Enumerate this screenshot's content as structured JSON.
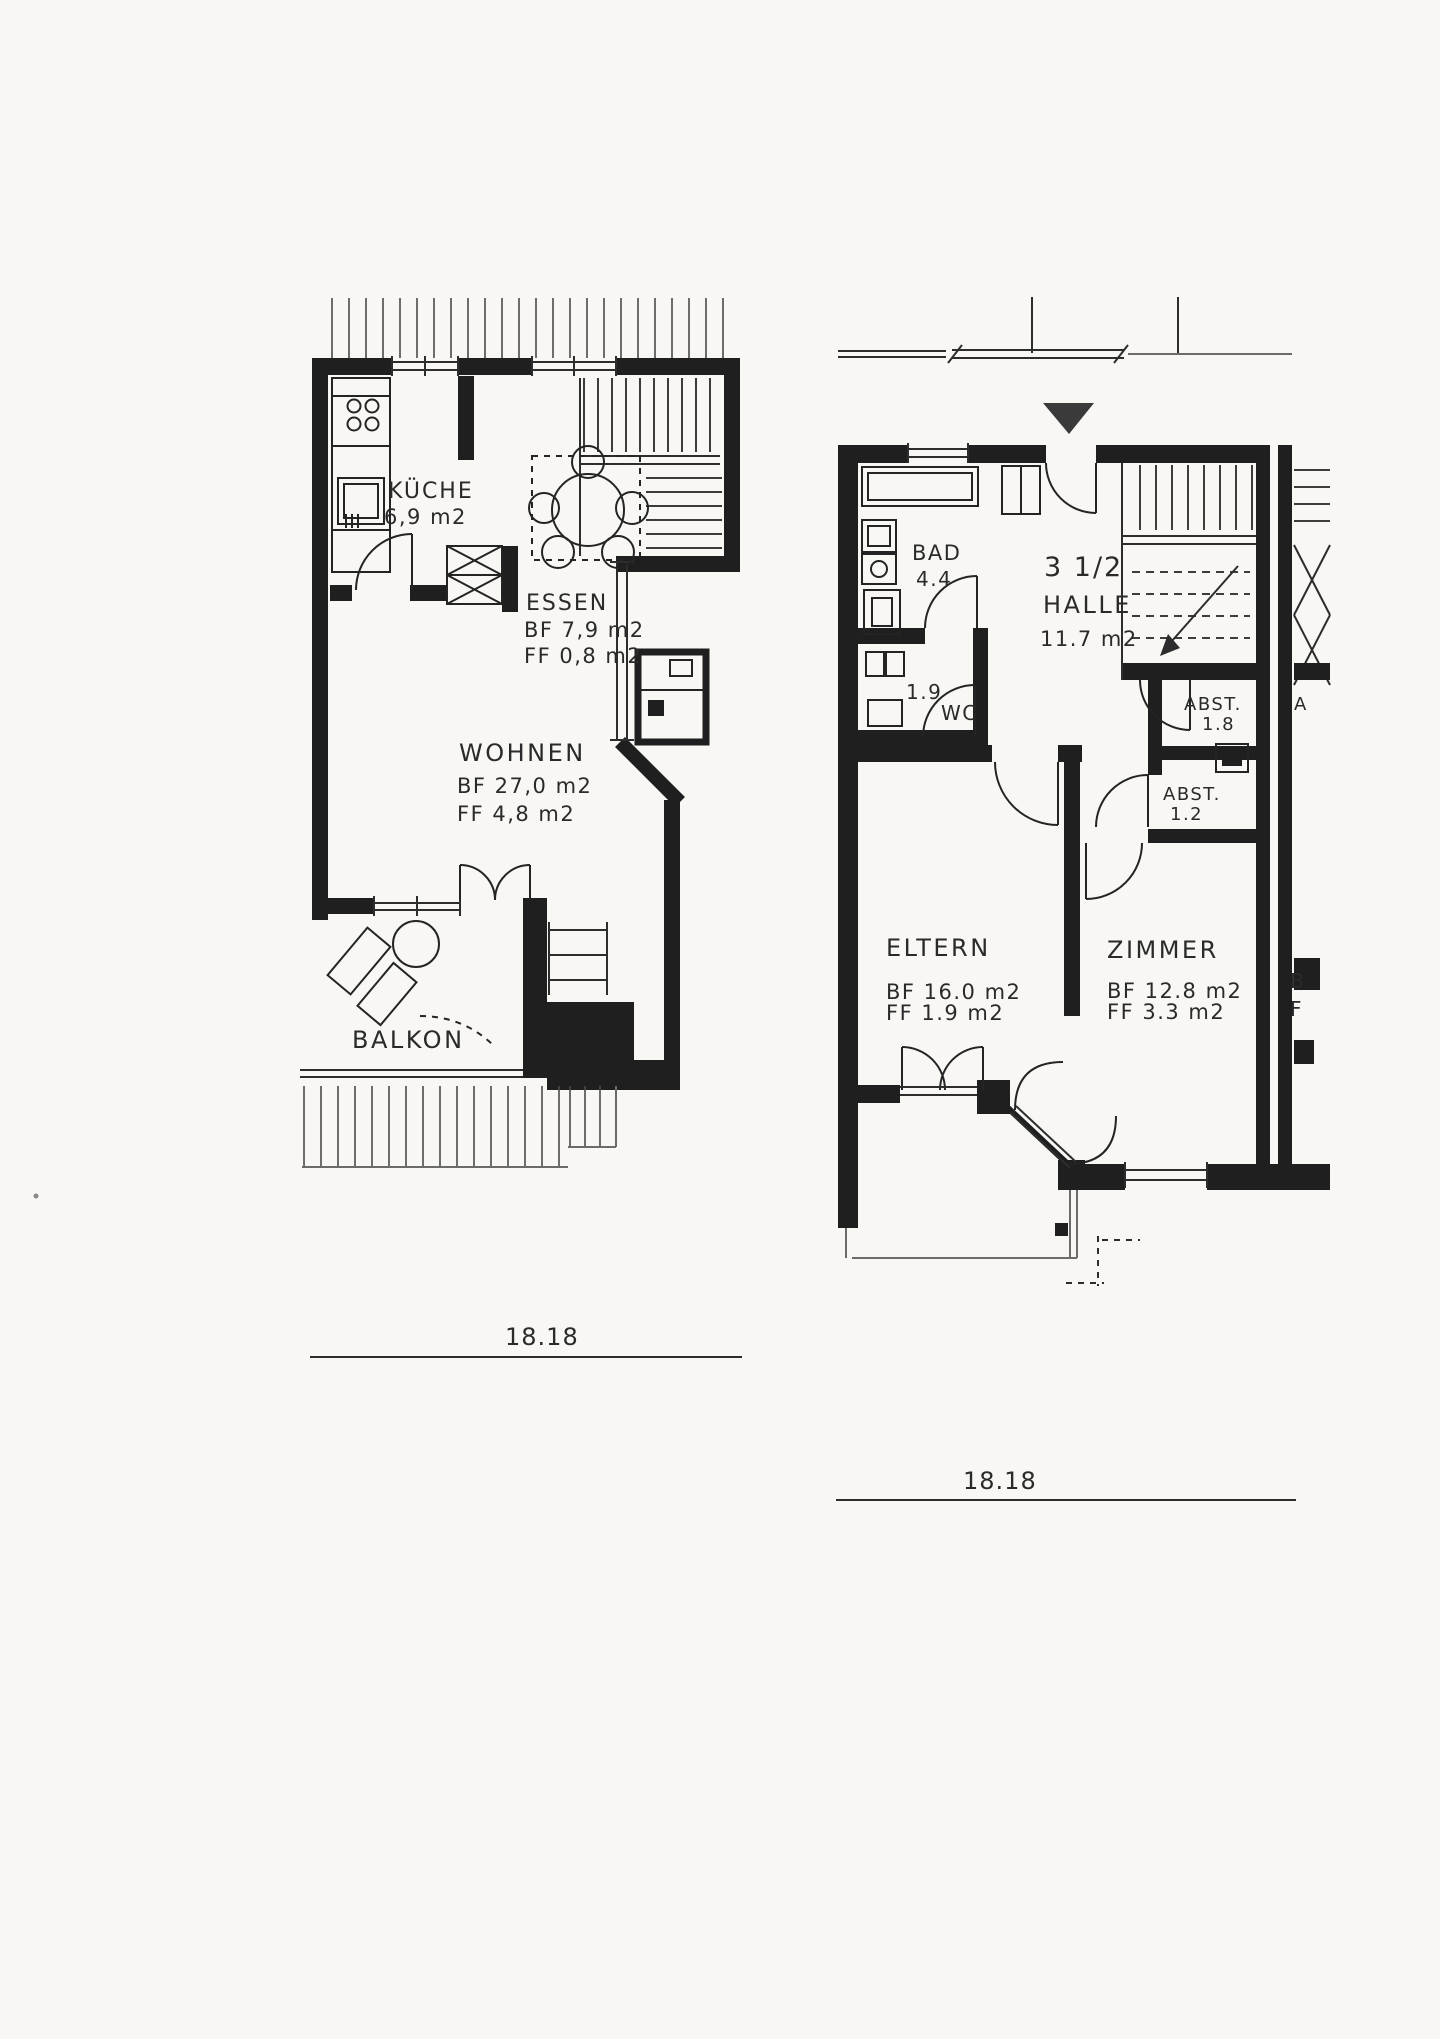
{
  "page": {
    "background": "#f8f7f4",
    "ink": "#1f1f1f"
  },
  "plans": {
    "left": {
      "kueche_label": "KÜCHE",
      "kueche_area": "6,9 m2",
      "essen_label": "ESSEN",
      "essen_bf": "BF 7,9  m2",
      "essen_ff": "FF 0,8 m2",
      "wohnen_label": "WOHNEN",
      "wohnen_bf": "BF 27,0  m2",
      "wohnen_ff": "FF  4,8  m2",
      "balkon_label": "BALKON",
      "dimension": "18.18"
    },
    "right": {
      "unit_size": "3 1/2",
      "bad_label": "BAD",
      "bad_area": "4.4",
      "halle_label": "HALLE",
      "halle_area": "11.7  m2",
      "wc_area": "1.9",
      "wc_label": "WC",
      "abst1_label": "ABST.",
      "abst1_area": "1.8",
      "abst2_label": "ABST.",
      "abst2_area": "1.2",
      "eltern_label": "ELTERN",
      "eltern_bf": "BF  16.0 m2",
      "eltern_ff": "FF   1.9 m2",
      "zimmer_label": "ZIMMER",
      "zimmer_bf": "BF 12.8 m2",
      "zimmer_ff": "FF  3.3 m2",
      "neighbor_fragment_a": "A",
      "neighbor_fragment_b": "B",
      "neighbor_fragment_f": "F",
      "dimension": "18.18"
    }
  }
}
